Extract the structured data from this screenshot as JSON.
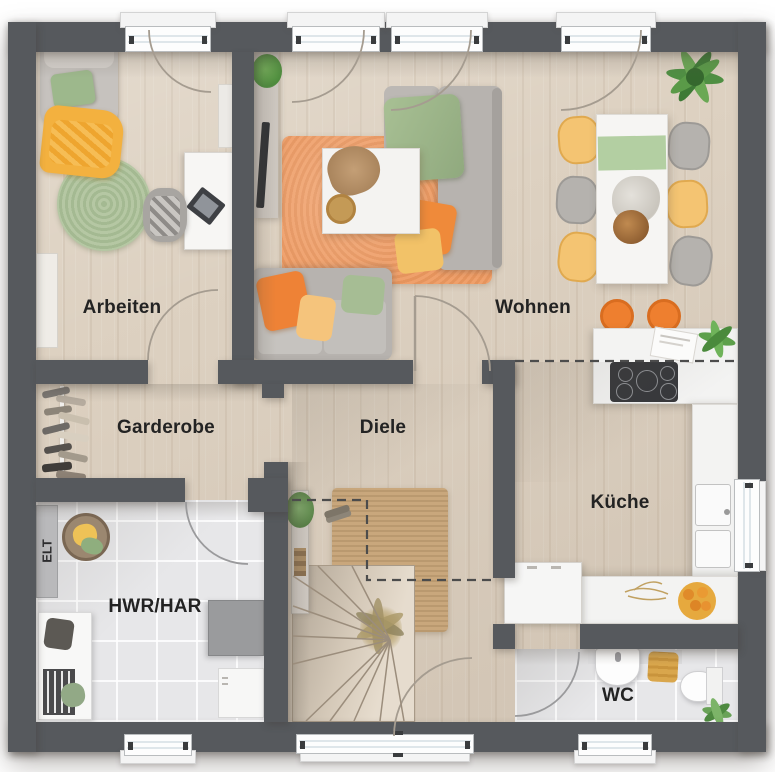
{
  "rooms": {
    "arbeiten": {
      "label": "Arbeiten"
    },
    "wohnen": {
      "label": "Wohnen"
    },
    "garderobe": {
      "label": "Garderobe"
    },
    "diele": {
      "label": "Diele"
    },
    "kueche": {
      "label": "Küche"
    },
    "hwr": {
      "label": "HWR/HAR"
    },
    "wc": {
      "label": "WC"
    },
    "elt": {
      "label": "ELT"
    }
  },
  "palette": {
    "wall": "#56595d",
    "wood_floor": "#ddd1c1",
    "tile_floor": "#e7e7e9",
    "counter_white": "#f3f3f2",
    "accent_orange": "#ee8236",
    "accent_peach_rug": "#efa06b",
    "accent_yellow": "#f2c268",
    "accent_green": "#9cb48a",
    "jute_rug": "#c8a478",
    "label_text": "#232323"
  }
}
